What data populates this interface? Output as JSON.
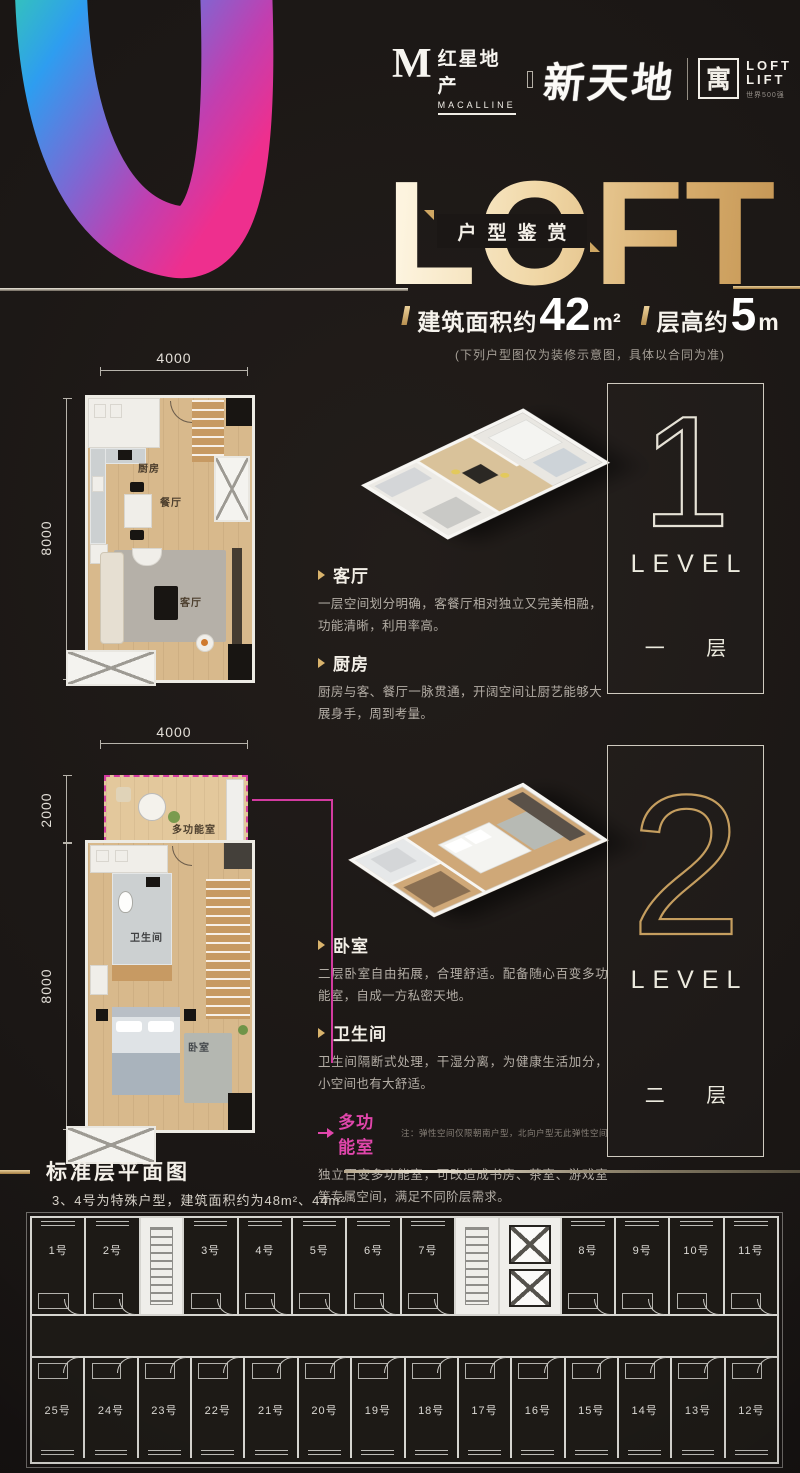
{
  "header": {
    "macalline": {
      "m": "M",
      "cn": "红星地产",
      "en": "MACALLINE"
    },
    "script": "新天地",
    "boyu": {
      "seal": "寓",
      "line1": "LOFT",
      "line2": "LIFT",
      "tagline": "世界500强"
    }
  },
  "hero": {
    "title": "LOFT",
    "band": "户型鉴赏",
    "area_label": "建筑面积约",
    "area_value": "42",
    "area_unit": "m²",
    "height_label": "层高约",
    "height_value": "5",
    "height_unit": "m",
    "note": "(下列户型图仅为装修示意图，具体以合同为准)"
  },
  "level1": {
    "plan": {
      "dim_top": "4000",
      "dim_left": "8000",
      "rooms": [
        "厨房",
        "餐厅",
        "客厅"
      ]
    },
    "badge": {
      "number": "1",
      "level": "LEVEL",
      "floor": "一 层"
    },
    "sections": [
      {
        "title": "客厅",
        "body": "一层空间划分明确，客餐厅相对独立又完美相融，功能清晰，利用率高。"
      },
      {
        "title": "厨房",
        "body": "厨房与客、餐厅一脉贯通，开阔空间让厨艺能够大展身手，周到考量。"
      }
    ]
  },
  "level2": {
    "plan": {
      "dim_top": "4000",
      "dim_left_upper": "2000",
      "dim_left": "8000",
      "rooms": [
        "多功能室",
        "卫生间",
        "卧室"
      ]
    },
    "badge": {
      "number": "2",
      "level": "LEVEL",
      "floor": "二 层"
    },
    "sections": [
      {
        "title": "卧室",
        "body": "二层卧室自由拓展，合理舒适。配备随心百变多功能室，自成一方私密天地。"
      },
      {
        "title": "卫生间",
        "body": "卫生间隔断式处理，干湿分离，为健康生活加分，小空间也有大舒适。"
      },
      {
        "title": "多功能室",
        "note": "注：弹性空间仅限朝南户型，北向户型无此弹性空间",
        "body": "独立百变多功能室，可改造成书房、茶室、游戏室等专属空间，满足不同阶层需求。"
      }
    ]
  },
  "standard_floor": {
    "title": "标准层平面图",
    "note": "3、4号为特殊户型，建筑面积约为48m²、44m²",
    "top_row": [
      "1号",
      "2号",
      "#stair",
      "3号",
      "4号",
      "5号",
      "6号",
      "7号",
      "#stair",
      "#elev",
      "8号",
      "9号",
      "10号",
      "11号"
    ],
    "bottom_row": [
      "25号",
      "24号",
      "23号",
      "22号",
      "21号",
      "20号",
      "19号",
      "18号",
      "17号",
      "16号",
      "15号",
      "14号",
      "13号",
      "12号"
    ]
  },
  "colors": {
    "background": "#1b1715",
    "gold": "#d9b36c",
    "magenta": "#d33ba0",
    "silver": "#e8e4da",
    "wood": "#d8b98c",
    "muted_text": "#b3ada5"
  }
}
